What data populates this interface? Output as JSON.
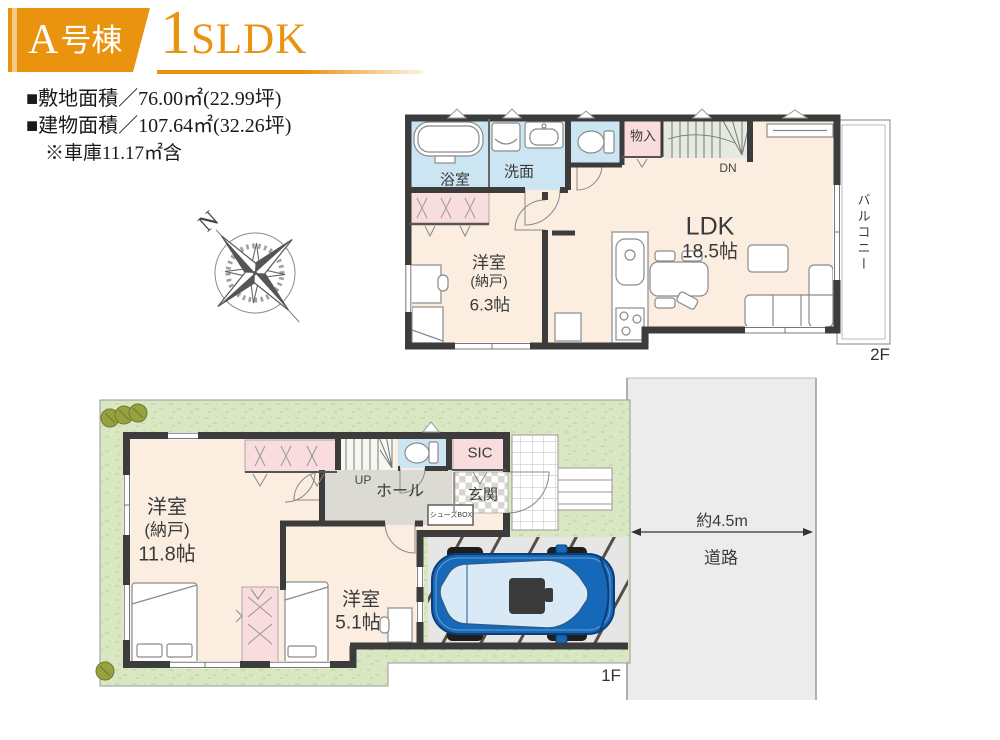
{
  "header": {
    "unit_label_main": "A",
    "unit_label_suffix": "号棟",
    "plan_digit": "1",
    "plan_letters": "SLDK"
  },
  "site_info": {
    "line1": "■敷地面積／76.00㎡(22.99坪)",
    "line2": "■建物面積／107.64㎡(32.26坪)",
    "line3": "※車庫11.17㎡含"
  },
  "compass": {
    "north": "N"
  },
  "floor2": {
    "floor_label": "2F",
    "bath": "浴室",
    "washroom": "洗面",
    "storage": "物入",
    "stairs_down": "DN",
    "ldk_name": "LDK",
    "ldk_size": "18.5帖",
    "room_name": "洋室",
    "room_sub": "(納戸)",
    "room_size": "6.3帖",
    "balcony": "バルコニー"
  },
  "floor1": {
    "floor_label": "1F",
    "main_room_name": "洋室",
    "main_room_sub": "(納戸)",
    "main_room_size": "11.8帖",
    "hall": "ホール",
    "stairs_up": "UP",
    "entrance": "玄関",
    "sic": "SIC",
    "shoes_box": "シューズBOX",
    "second_room_name": "洋室",
    "second_room_size": "5.1帖",
    "road_width": "約4.5m",
    "road": "道路"
  },
  "colors": {
    "accent_orange": "#E9930F",
    "wall_dark": "#3C3C3C",
    "room_cream": "#FBEEE1",
    "closet_pink": "#F8DCDE",
    "wet_area_blue": "#CBE5F3",
    "hall_gray": "#DBDBD3",
    "stairs_green": "#E4EAE0",
    "entry_tile_gray": "#D7D7CF",
    "grass_green": "#D9E7C3",
    "road_gray": "#ECECEC",
    "carport_gray": "#E6E6E6",
    "carport_stripe": "#5A4C42",
    "car_blue": "#1569B8"
  }
}
